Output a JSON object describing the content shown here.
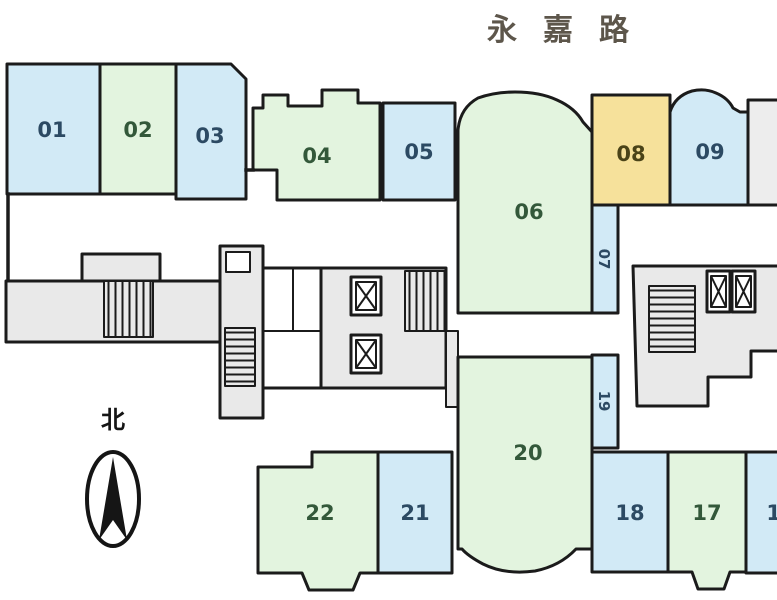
{
  "street": {
    "name": "永嘉路"
  },
  "compass": {
    "north_label": "北",
    "icon": "north-arrow-compass"
  },
  "palette": {
    "wall": "#1b1b1b",
    "room_blue": "#d2eaf6",
    "room_green": "#e3f4df",
    "room_yellow": "#f6e19b",
    "room_gray": "#ededed",
    "corridor_gray": "#e9e9e9",
    "label_on_blue": "#2c4a63",
    "label_on_green": "#33583a",
    "label_on_yellow": "#4a4318",
    "street_text": "#5d564b"
  },
  "rooms": {
    "r01": {
      "label": "01",
      "color": "blue"
    },
    "r02": {
      "label": "02",
      "color": "green"
    },
    "r03": {
      "label": "03",
      "color": "blue"
    },
    "r04": {
      "label": "04",
      "color": "green"
    },
    "r05": {
      "label": "05",
      "color": "blue"
    },
    "r06": {
      "label": "06",
      "color": "green"
    },
    "r07": {
      "label": "07",
      "color": "blue"
    },
    "r08": {
      "label": "08",
      "color": "yellow"
    },
    "r09": {
      "label": "09",
      "color": "blue"
    },
    "r16": {
      "label": "16",
      "color": "blue"
    },
    "r17": {
      "label": "17",
      "color": "green"
    },
    "r18": {
      "label": "18",
      "color": "blue"
    },
    "r19": {
      "label": "19",
      "color": "blue"
    },
    "r20": {
      "label": "20",
      "color": "green"
    },
    "r21": {
      "label": "21",
      "color": "blue"
    },
    "r22": {
      "label": "22",
      "color": "green"
    }
  },
  "core": {
    "staircase_icon": "staircase-hatched",
    "elevator_icon": "elevator-x-box",
    "staircases": 4,
    "elevators": 4
  }
}
